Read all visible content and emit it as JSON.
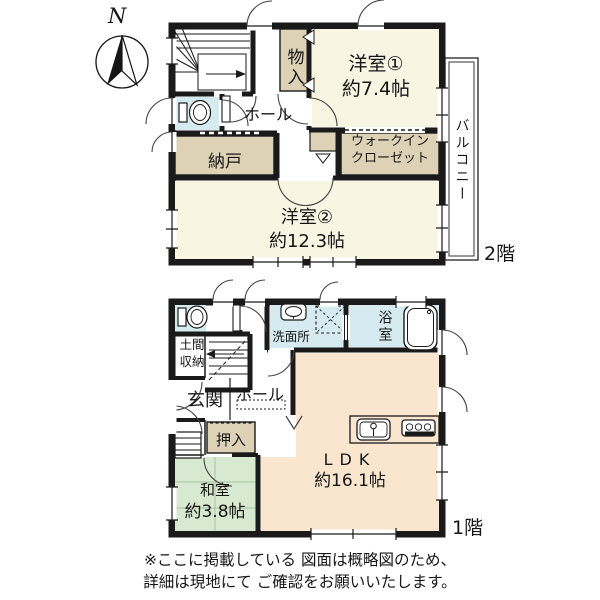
{
  "compass": {
    "label": "N"
  },
  "floor2": {
    "floor_label": "2階",
    "rooms": {
      "storage_upper": "物入",
      "bedroom1_name": "洋室①",
      "bedroom1_size": "約7.4帖",
      "hall": "ホール",
      "closet_room": "納戸",
      "wic_line1": "ウォークイン",
      "wic_line2": "クローゼット",
      "bedroom2_name": "洋室②",
      "bedroom2_size": "約12.3帖",
      "balcony": "バルコニー"
    }
  },
  "floor1": {
    "floor_label": "1階",
    "rooms": {
      "doma_line1": "土間",
      "doma_line2": "収納",
      "entrance": "玄関",
      "hall": "ホール",
      "washroom": "洗面所",
      "bathroom": "浴室",
      "oshiire": "押入",
      "tatami_name": "和室",
      "tatami_size": "約3.8帖",
      "ldk_name": "LDK",
      "ldk_size": "約16.1帖"
    }
  },
  "footnote": {
    "line1": "※ここに掲載している 図面は概略図のため、",
    "line2": "詳細は現地にて ご確認をお願いいたします。"
  },
  "colors": {
    "wall": "#1a1a1a",
    "western_room": "#f8f5e3",
    "storage": "#ddd2b6",
    "wet_area": "#d6ebf0",
    "ldk": "#fae5cf",
    "tatami": "#d8e9d1",
    "tatami_line": "#a9c2a0"
  }
}
